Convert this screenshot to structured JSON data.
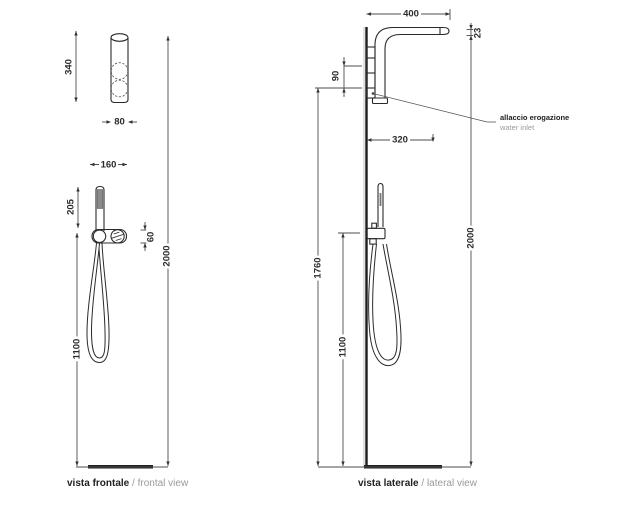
{
  "frontal": {
    "caption": {
      "title": "vista frontale",
      "subtitle": "/ frontal view"
    },
    "dims": {
      "panel_height": "340",
      "panel_width": "80",
      "mixer_width": "160",
      "handshower_height": "205",
      "mixer_height": "60",
      "hose_drop": "1100",
      "total_height": "2000"
    }
  },
  "lateral": {
    "caption": {
      "title": "vista laterale",
      "subtitle": "/ lateral view"
    },
    "dims": {
      "arm_reach": "400",
      "arm_thickness": "23",
      "bracket_height": "90",
      "inlet_offset": "320",
      "inlet_height": "1760",
      "hose_drop": "1100",
      "total_height": "2000"
    },
    "callout": {
      "label_it": "allaccio erogazione",
      "label_en": "water inlet"
    }
  },
  "colors": {
    "object_line": "#2b2b2b",
    "dim_line": "#4d4d4d",
    "muted_text": "#9a9a9a",
    "background": "#ffffff"
  }
}
